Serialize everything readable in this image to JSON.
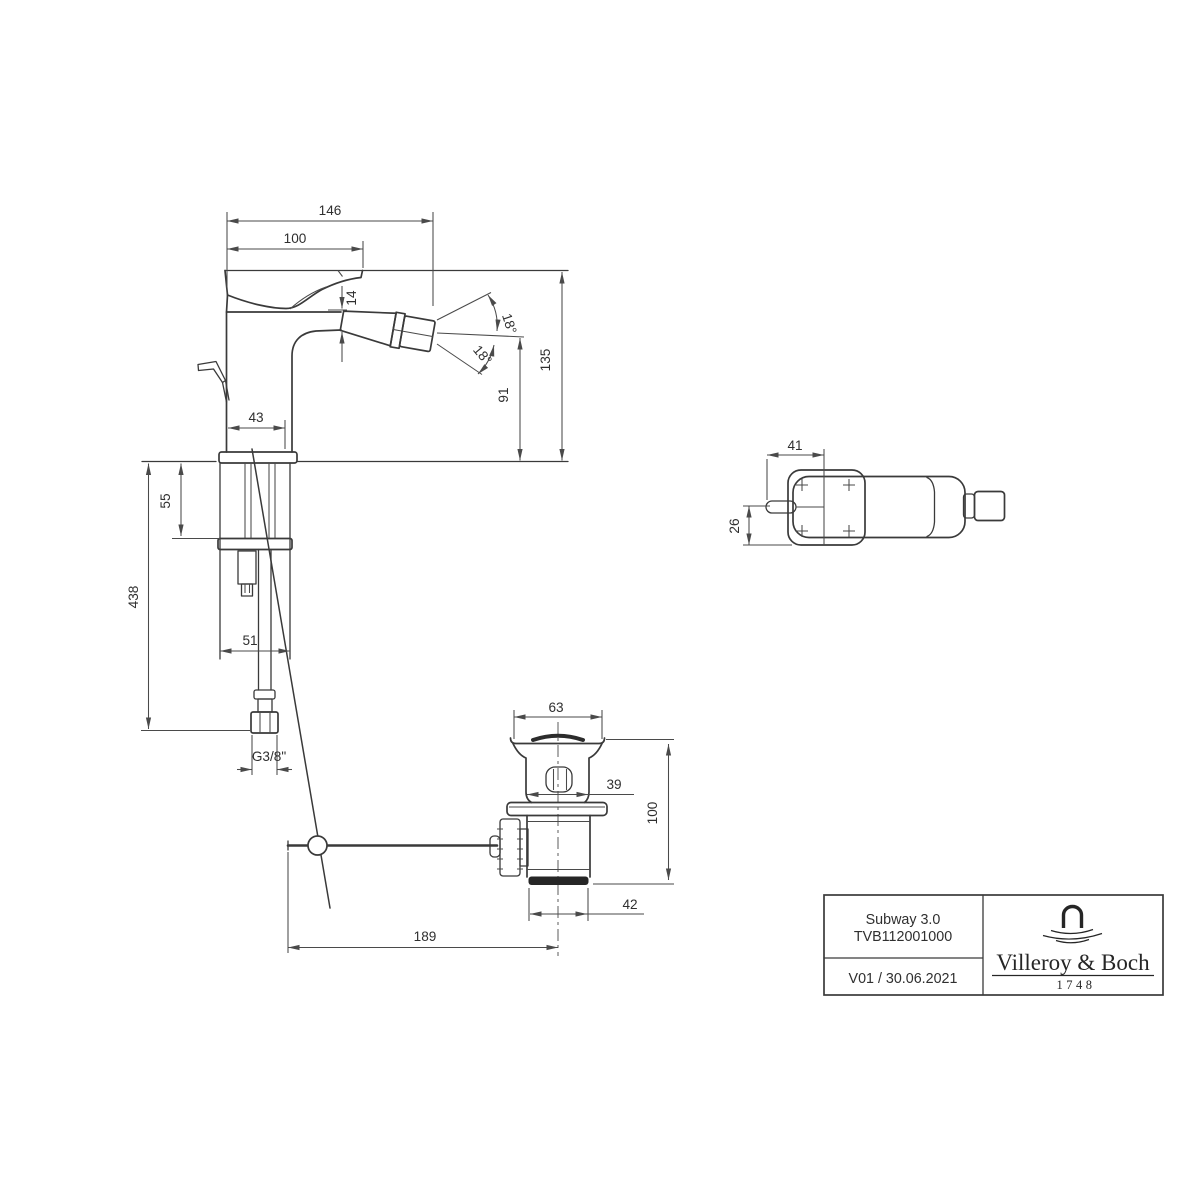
{
  "dims": {
    "total_length": "146",
    "spout_reach": "100",
    "spout_mouth": "14",
    "spray_angle_upper": "18°",
    "spray_angle_lower": "18°",
    "outlet_height": "91",
    "total_height": "135",
    "body_depth": "43",
    "max_counter_thickness": "55",
    "hose_length": "438",
    "shaft_width": "51",
    "thread": "G3/8\"",
    "waste_cap_dia": "63",
    "waste_neck": "39",
    "waste_height": "100",
    "waste_body_dia": "42",
    "rod_reach": "189",
    "top_length": "41",
    "top_offset": "26"
  },
  "title_block": {
    "product_name": "Subway 3.0",
    "article_number": "TVB112001000",
    "version_date": "V01 / 30.06.2021",
    "brand": "Villeroy & Boch",
    "brand_year": "1748"
  }
}
